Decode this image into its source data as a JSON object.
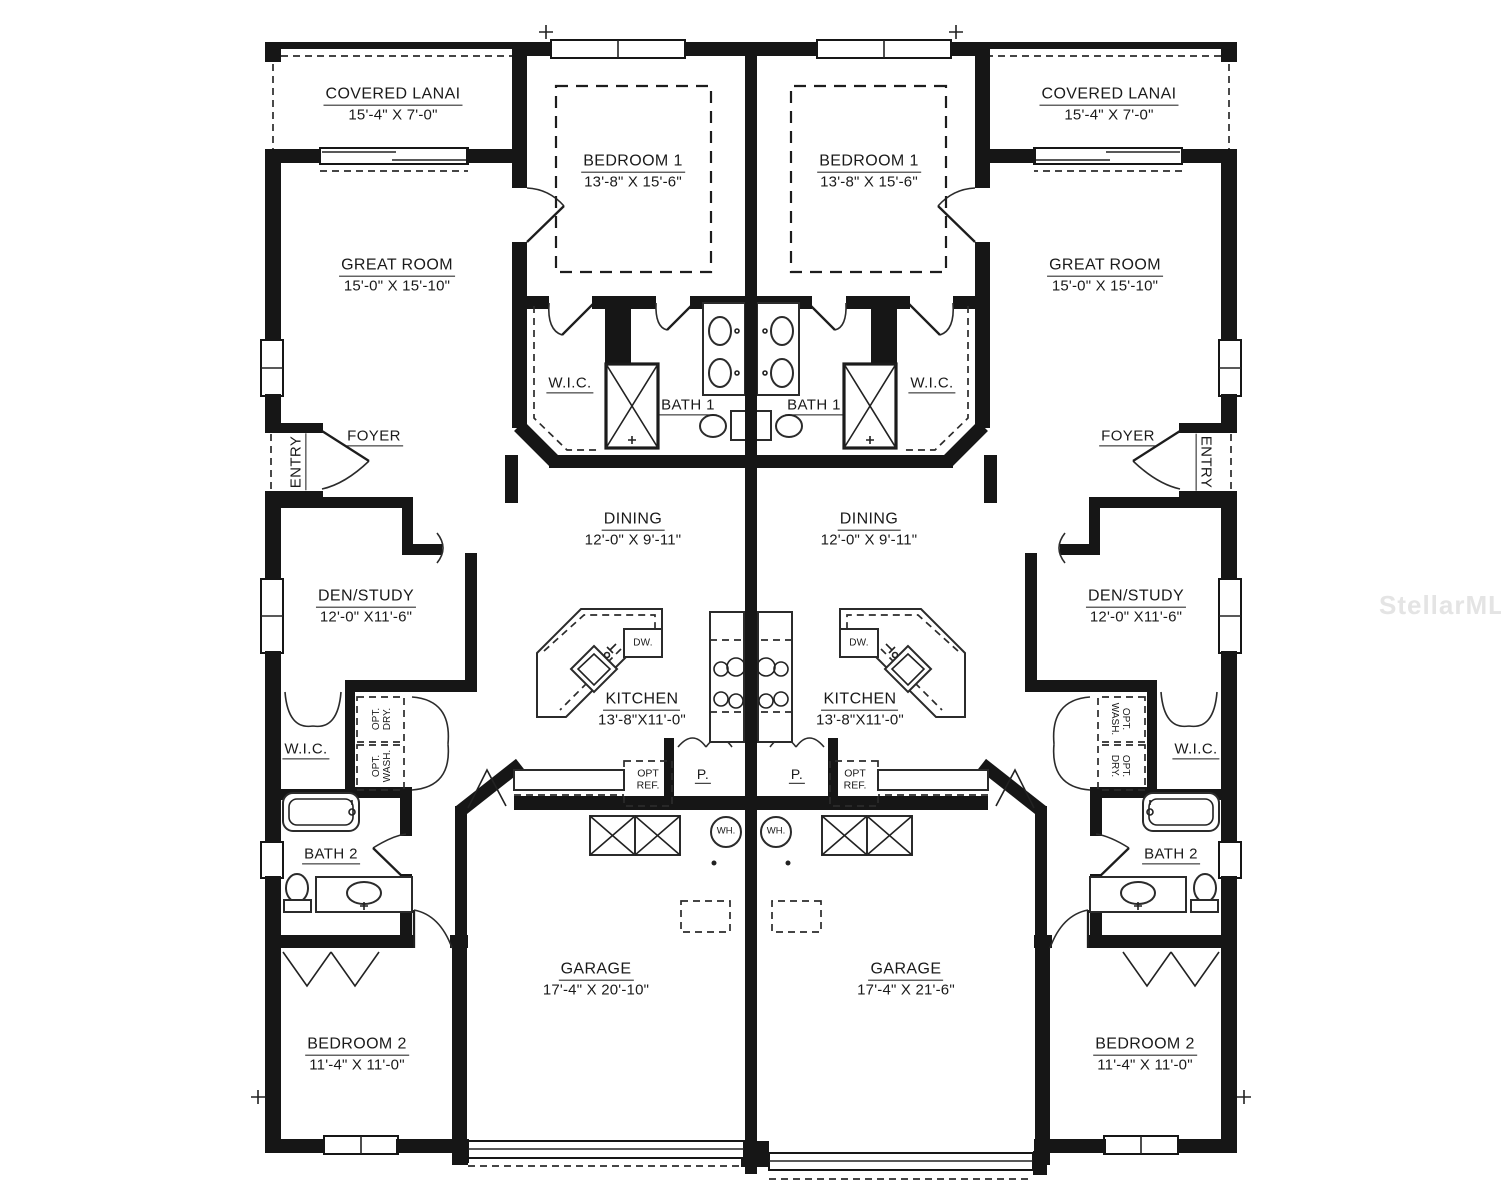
{
  "watermark": "StellarMLS",
  "plan": {
    "left_unit": {
      "covered_lanai": {
        "name": "COVERED LANAI",
        "dims": "15'-4\" X 7'-0\""
      },
      "bedroom1": {
        "name": "BEDROOM 1",
        "dims": "13'-8\" X 15'-6\""
      },
      "great_room": {
        "name": "GREAT ROOM",
        "dims": "15'-0\" X 15'-10\""
      },
      "wic_upper": "W.I.C.",
      "bath1": "BATH 1",
      "foyer": "FOYER",
      "entry": "ENTRY",
      "den_study": {
        "name": "DEN/STUDY",
        "dims": "12'-0\" X11'-6\""
      },
      "dining": {
        "name": "DINING",
        "dims": "12'-0\" X 9'-11\""
      },
      "kitchen": {
        "name": "KITCHEN",
        "dims": "13'-8\"X11'-0\""
      },
      "dishwasher": "DW.",
      "opt_dryer": "OPT. DRY.",
      "opt_washer": "OPT. WASH.",
      "wic_lower": "W.I.C.",
      "bath2": "BATH 2",
      "opt_fridge": "OPT REF.",
      "pantry": "P.",
      "water_heater": "WH.",
      "garage": {
        "name": "GARAGE",
        "dims": "17'-4\" X 20'-10\""
      },
      "bedroom2": {
        "name": "BEDROOM 2",
        "dims": "11'-4\" X 11'-0\""
      }
    },
    "right_unit": {
      "covered_lanai": {
        "name": "COVERED LANAI",
        "dims": "15'-4\" X 7'-0\""
      },
      "bedroom1": {
        "name": "BEDROOM 1",
        "dims": "13'-8\" X 15'-6\""
      },
      "great_room": {
        "name": "GREAT ROOM",
        "dims": "15'-0\" X 15'-10\""
      },
      "wic_upper": "W.I.C.",
      "bath1": "BATH 1",
      "foyer": "FOYER",
      "entry": "ENTRY",
      "den_study": {
        "name": "DEN/STUDY",
        "dims": "12'-0\" X11'-6\""
      },
      "dining": {
        "name": "DINING",
        "dims": "12'-0\" X 9'-11\""
      },
      "kitchen": {
        "name": "KITCHEN",
        "dims": "13'-8\"X11'-0\""
      },
      "dishwasher": "DW.",
      "opt_dryer": "OPT. DRY.",
      "opt_washer": "OPT. WASH.",
      "wic_lower": "W.I.C.",
      "bath2": "BATH 2",
      "opt_fridge": "OPT REF.",
      "pantry": "P.",
      "water_heater": "WH.",
      "garage": {
        "name": "GARAGE",
        "dims": "17'-4\" X 21'-6\""
      },
      "bedroom2": {
        "name": "BEDROOM 2",
        "dims": "11'-4\" X 11'-0\""
      }
    }
  }
}
